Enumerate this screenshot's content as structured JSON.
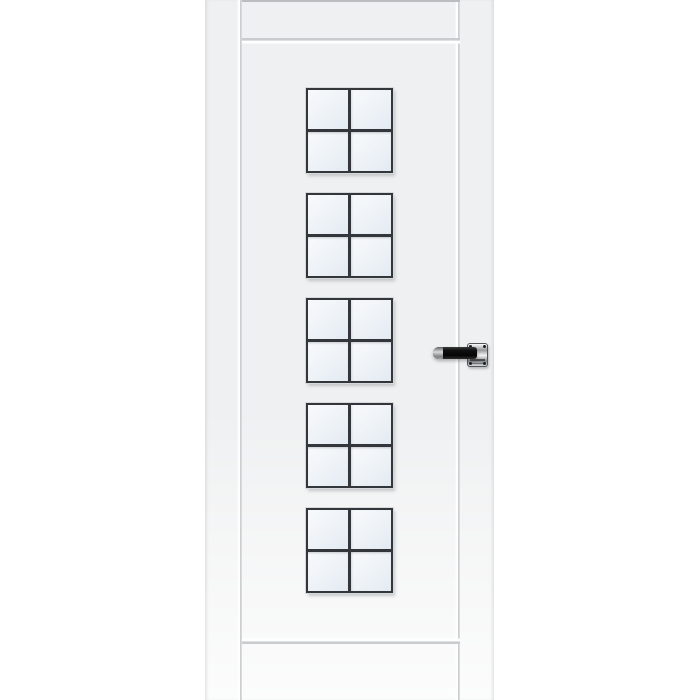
{
  "scene": {
    "type": "product-photo",
    "subject": "White interior door, partially cropped, with five square four-pane glazed windows stacked vertically and a black lever handle on the right stile",
    "background_color": "#ffffff"
  },
  "door": {
    "slab_color": "#eff0f1",
    "bottom_sheen_color": "#fafbfb",
    "groove_line_color": "#c9cccf",
    "groove_highlight_color": "#ffffff",
    "stile_groove_count": 2,
    "rail_grooves": [
      "top-edge",
      "top-rail",
      "bottom-rail"
    ]
  },
  "windows": {
    "count": 5,
    "grid": "2x2",
    "panes_per_window": 4,
    "frame_color": "#33363b",
    "muntin_color": "#33363b",
    "glass_color": "#edf2f7",
    "frame_halo_color": "#d6d9dc"
  },
  "handle": {
    "side": "right",
    "style": "lever-on-square-rosette",
    "lever_color": "#111111",
    "lever_tip_color": "#b5b5b5",
    "rosette_color": "#c7c9cb",
    "rosette_border_color": "#53565a",
    "screw_color": "#1d1f21",
    "screw_count": 4
  }
}
